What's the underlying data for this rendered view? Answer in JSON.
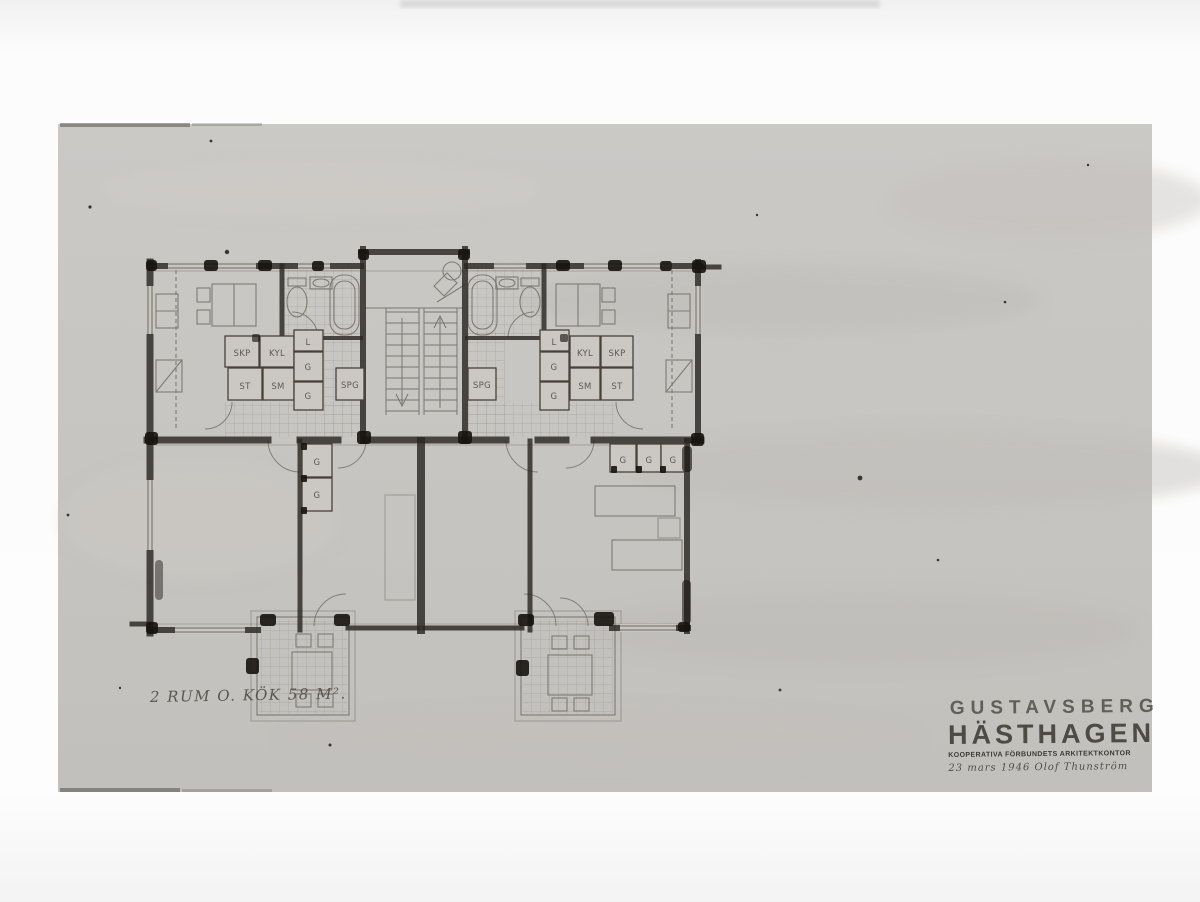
{
  "colors": {
    "photo_paper": "#c7c4c0",
    "ink": "#2b2722",
    "pencil": "#726e66",
    "page_background": "#fafafa"
  },
  "caption": {
    "area_label": "2 RUM O. KÖK 58 M²."
  },
  "stamp": {
    "project_location": "GUSTAVSBERG",
    "project_name": "HÄSTHAGEN",
    "office": "KOOPERATIVA FÖRBUNDETS ARKITEKTKONTOR",
    "date_signature": "23 mars 1946   Olof Thunström"
  },
  "plan": {
    "labels": {
      "skp_left": "SKP",
      "kyl_left": "KYL",
      "st_left": "ST",
      "sm_left": "SM",
      "l_left": "L",
      "g_left_1": "G",
      "g_left_2": "G",
      "spg_left": "SPG",
      "spg_right": "SPG",
      "l_right": "L",
      "g_right_1": "G",
      "g_right_2": "G",
      "kyl_right": "KYL",
      "skp_right": "SKP",
      "sm_right": "SM",
      "st_right": "ST",
      "g_hall_left_1": "G",
      "g_hall_left_2": "G",
      "g_hall_right_1": "G",
      "g_hall_right_2": "G",
      "g_hall_right_3": "G"
    }
  }
}
